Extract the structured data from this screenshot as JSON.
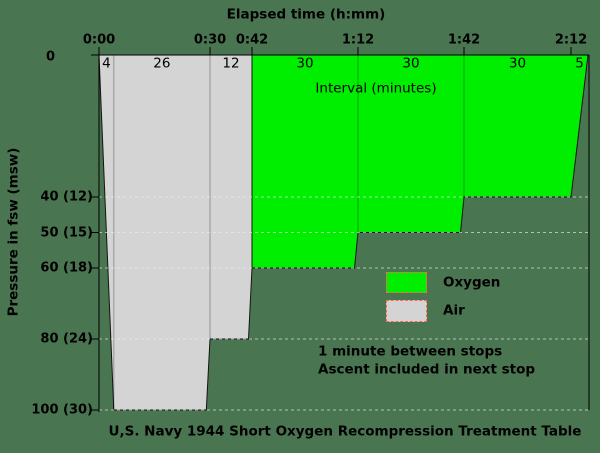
{
  "chart_data": {
    "type": "area",
    "title": "U,S. Navy 1944 Short Oxygen Recompression Treatment Table",
    "x_axis": {
      "label": "Elapsed time (h:mm)",
      "tick_minutes": [
        0,
        30,
        42,
        72,
        102,
        132
      ],
      "tick_labels": [
        "0:00",
        "0:30",
        "0:42",
        "1:12",
        "1:42",
        "2:12"
      ]
    },
    "y_axis": {
      "label": "Pressure in fsw (msw)",
      "tick_fsw": [
        0,
        40,
        50,
        60,
        80,
        100
      ],
      "tick_labels": [
        "0",
        "40 (12)",
        "50 (15)",
        "60 (18)",
        "80 (24)",
        "100 (30)"
      ],
      "range": [
        0,
        100
      ]
    },
    "interval_axis_label": "Interval (minutes)",
    "profile": [
      {
        "label": "4",
        "minutes": 4,
        "gas": "air",
        "type": "descent",
        "from_fsw": 0,
        "to_fsw": 100
      },
      {
        "label": "26",
        "minutes": 26,
        "gas": "air",
        "type": "stop",
        "depth_fsw": 100
      },
      {
        "label": "12",
        "minutes": 12,
        "gas": "air",
        "type": "stop",
        "depth_fsw": 80
      },
      {
        "label": "30",
        "minutes": 30,
        "gas": "oxygen",
        "type": "stop",
        "depth_fsw": 60
      },
      {
        "label": "30",
        "minutes": 30,
        "gas": "oxygen",
        "type": "stop",
        "depth_fsw": 50
      },
      {
        "label": "30",
        "minutes": 30,
        "gas": "oxygen",
        "type": "stop",
        "depth_fsw": 40
      },
      {
        "label": "5",
        "minutes": 5,
        "gas": "oxygen",
        "type": "ascent",
        "from_fsw": 40,
        "to_fsw": 0
      }
    ],
    "legend": [
      {
        "label": "Oxygen",
        "color": "#00ee00"
      },
      {
        "label": "Air",
        "color": "#d4d4d4"
      }
    ],
    "notes": [
      "1 minute between stops",
      "Ascent included in next stop"
    ],
    "gridlines_fsw": [
      40,
      50,
      60,
      80,
      100
    ],
    "colors": {
      "oxygen": "#00ee00",
      "air": "#d4d4d4",
      "background": "#4a7551",
      "outline": "#141414",
      "grid": "rgba(235,235,235,0.65)",
      "separator": "rgba(0,0,0,0.3)",
      "legend_border": "#ff6655",
      "text": "#000000"
    },
    "layout": {
      "plot": {
        "left": 99,
        "right": 589,
        "top": 55
      },
      "px_per_fsw": 3.55,
      "time_anchors_px": [
        [
          0,
          99
        ],
        [
          30,
          210
        ],
        [
          42,
          252
        ],
        [
          72,
          358
        ],
        [
          102,
          464
        ],
        [
          132,
          571
        ],
        [
          137,
          588
        ]
      ],
      "x_tick_label_y": 40,
      "interval_label_y": 64,
      "y_tick_label_right": 93
    }
  }
}
